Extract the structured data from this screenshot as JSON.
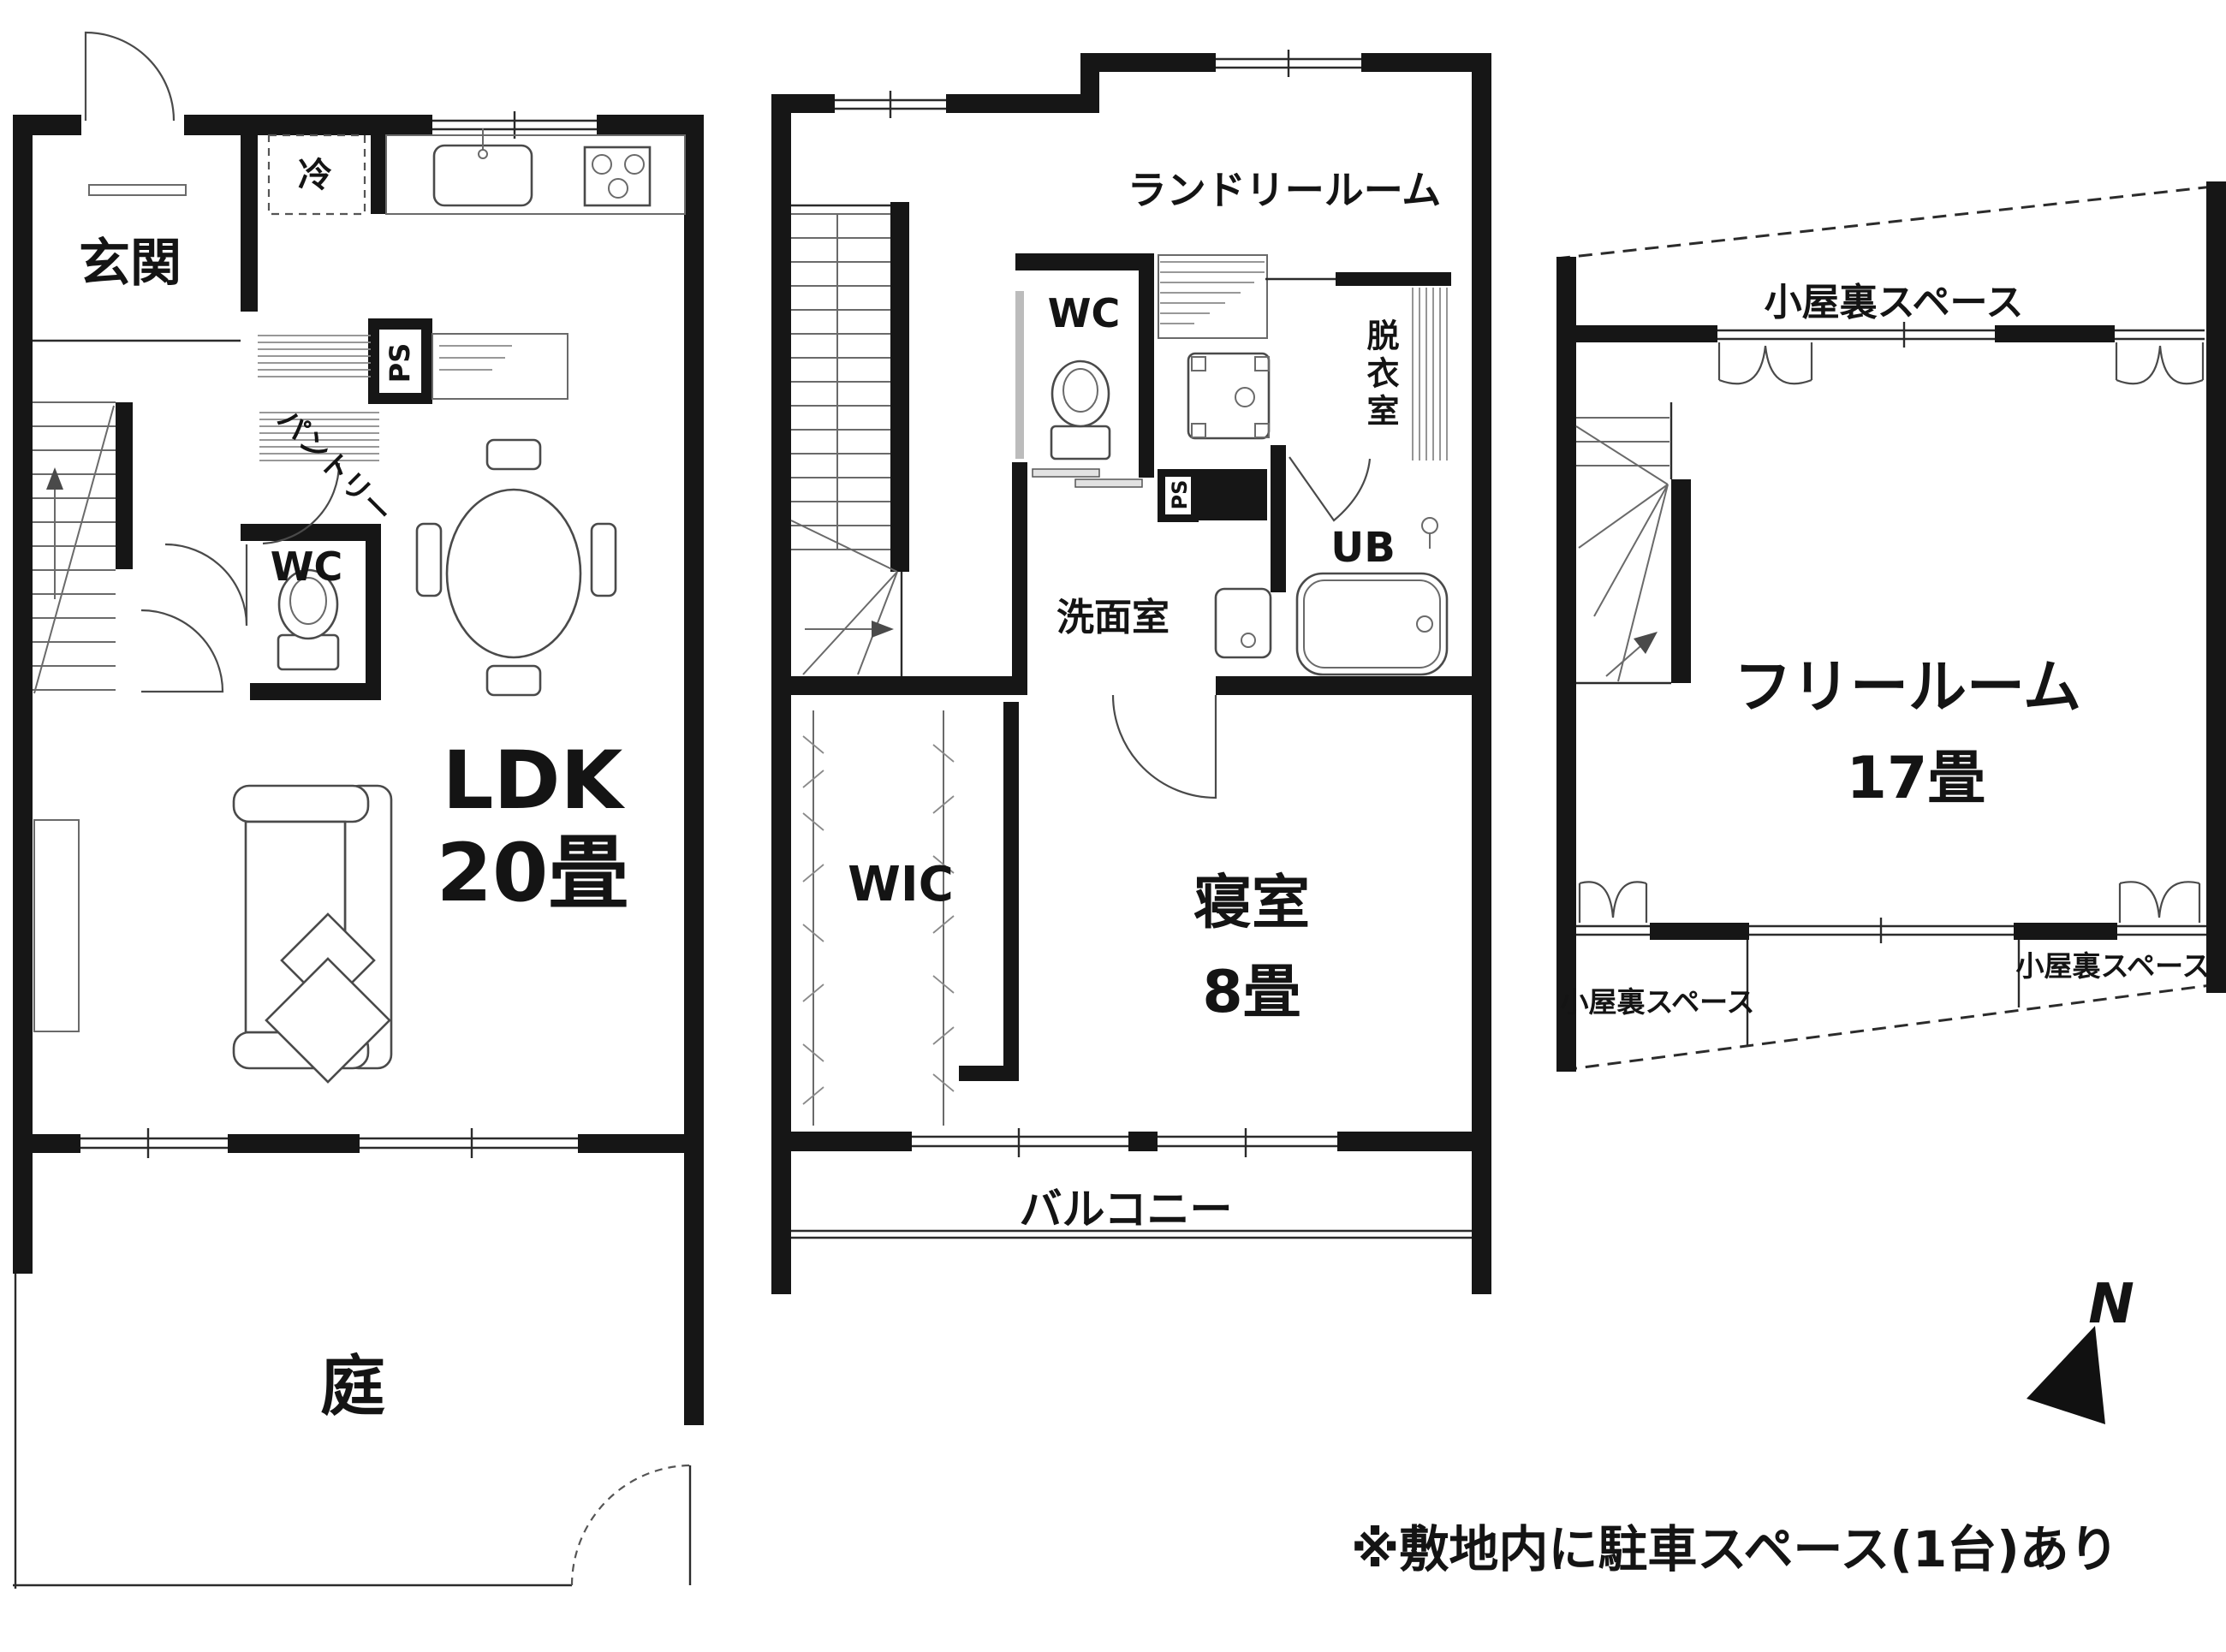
{
  "floor1": {
    "genkan": "玄関",
    "fridge": "冷",
    "ps": "PS",
    "pantry": "パントリー",
    "wc": "WC",
    "ldk": "LDK",
    "ldk_size": "20畳",
    "garden": "庭"
  },
  "floor2": {
    "laundry_room": "ランドリールーム",
    "wc": "WC",
    "dressing_room": "脱衣室",
    "ps": "PS",
    "unit_bath": "UB",
    "washroom": "洗面室",
    "walk_in_closet": "WIC",
    "bedroom": "寝室",
    "bedroom_size": "8畳",
    "balcony": "バルコニー"
  },
  "floor3": {
    "attic_top": "小屋裏スペース",
    "attic_bottom_left": "小屋裏スペース",
    "attic_bottom_right": "小屋裏スペース",
    "free_room": "フリールーム",
    "free_room_size": "17畳"
  },
  "compass_north": "N",
  "note": "※敷地内に駐車スペース(1台)あり",
  "colors": {
    "wall": "#161616",
    "line": "#2b2b2b",
    "background": "#ffffff"
  }
}
